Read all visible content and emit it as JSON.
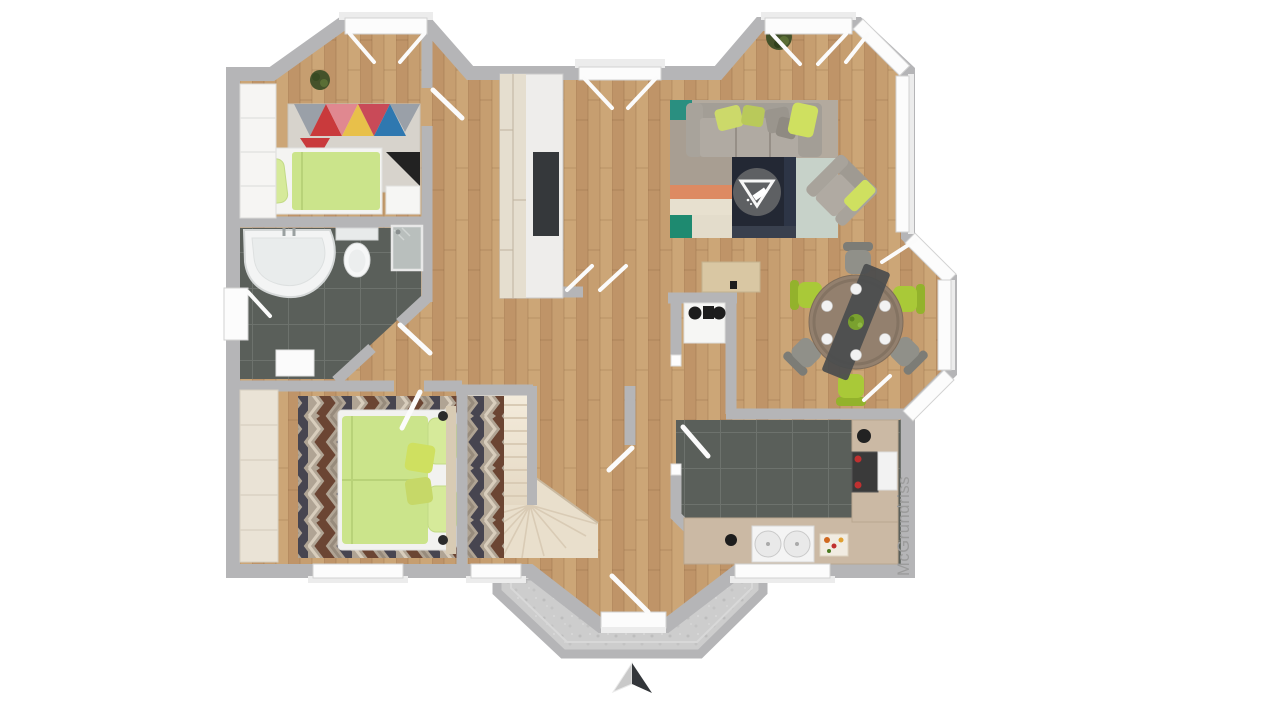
{
  "meta": {
    "watermark_text": "McGrundriss",
    "compass_direction": "N",
    "image_kind": "3d-top-down-floor-plan"
  },
  "palette": {
    "bg": "#ffffff",
    "wall": "#b5b5b7",
    "window": "#fcfcfc",
    "window_frame": "#d2d2d2",
    "door_leaf": "#fbfbfb",
    "wood": "#c69e70",
    "wood_dark": "#bf9468",
    "wood_light": "#cca677",
    "tile": "#5a5f5a",
    "tile_line": "#6d726d",
    "stair": "#ece2d0",
    "stair_line": "#d9cbb5",
    "porch_stone": "#cdcdcd",
    "green_duvet": "#cbe48b",
    "green_pillow": "#d6ea9a",
    "green_accent": "#cfe060",
    "green_chair": "#a9c938",
    "sofa_gray": "#a39e96",
    "sofa_seat": "#b0aaa2",
    "rug_living_base": "#b3aa9e",
    "rug_navy": "#232834",
    "rug_teal": "#1e8a70",
    "rug_orange": "#dd8a62",
    "rug_cream": "#e7e0cf",
    "rug_pale": "#c7d2c9",
    "rug_chev_dark": "#474550",
    "rug_chev_brown": "#6b4533",
    "rug_chev_tan": "#b0a494",
    "tri_red": "#c93a3c",
    "tri_pink": "#e08890",
    "tri_blue": "#2f78b0",
    "tri_yellow": "#e8c04a",
    "tri_gray": "#9aa0a8",
    "tri_black": "#222222",
    "table_wood": "#93806e",
    "runner_dark": "#4a4c4e",
    "chair_gray": "#909089",
    "counter": "#cbb9a4",
    "fixture_white": "#f4f4f4",
    "stove_dark": "#3a3a3a",
    "stove_red": "#c03030",
    "plant_green": "#44522a",
    "wardrobe_white": "#f6f5f3",
    "wardrobe_wood": "#eae3d6",
    "tv_dark": "#35383b",
    "logo_gray": "#777777",
    "watermark_gray": "#9b9b9b",
    "arrow_light": "#c9c9c9",
    "arrow_dark": "#33363a"
  }
}
